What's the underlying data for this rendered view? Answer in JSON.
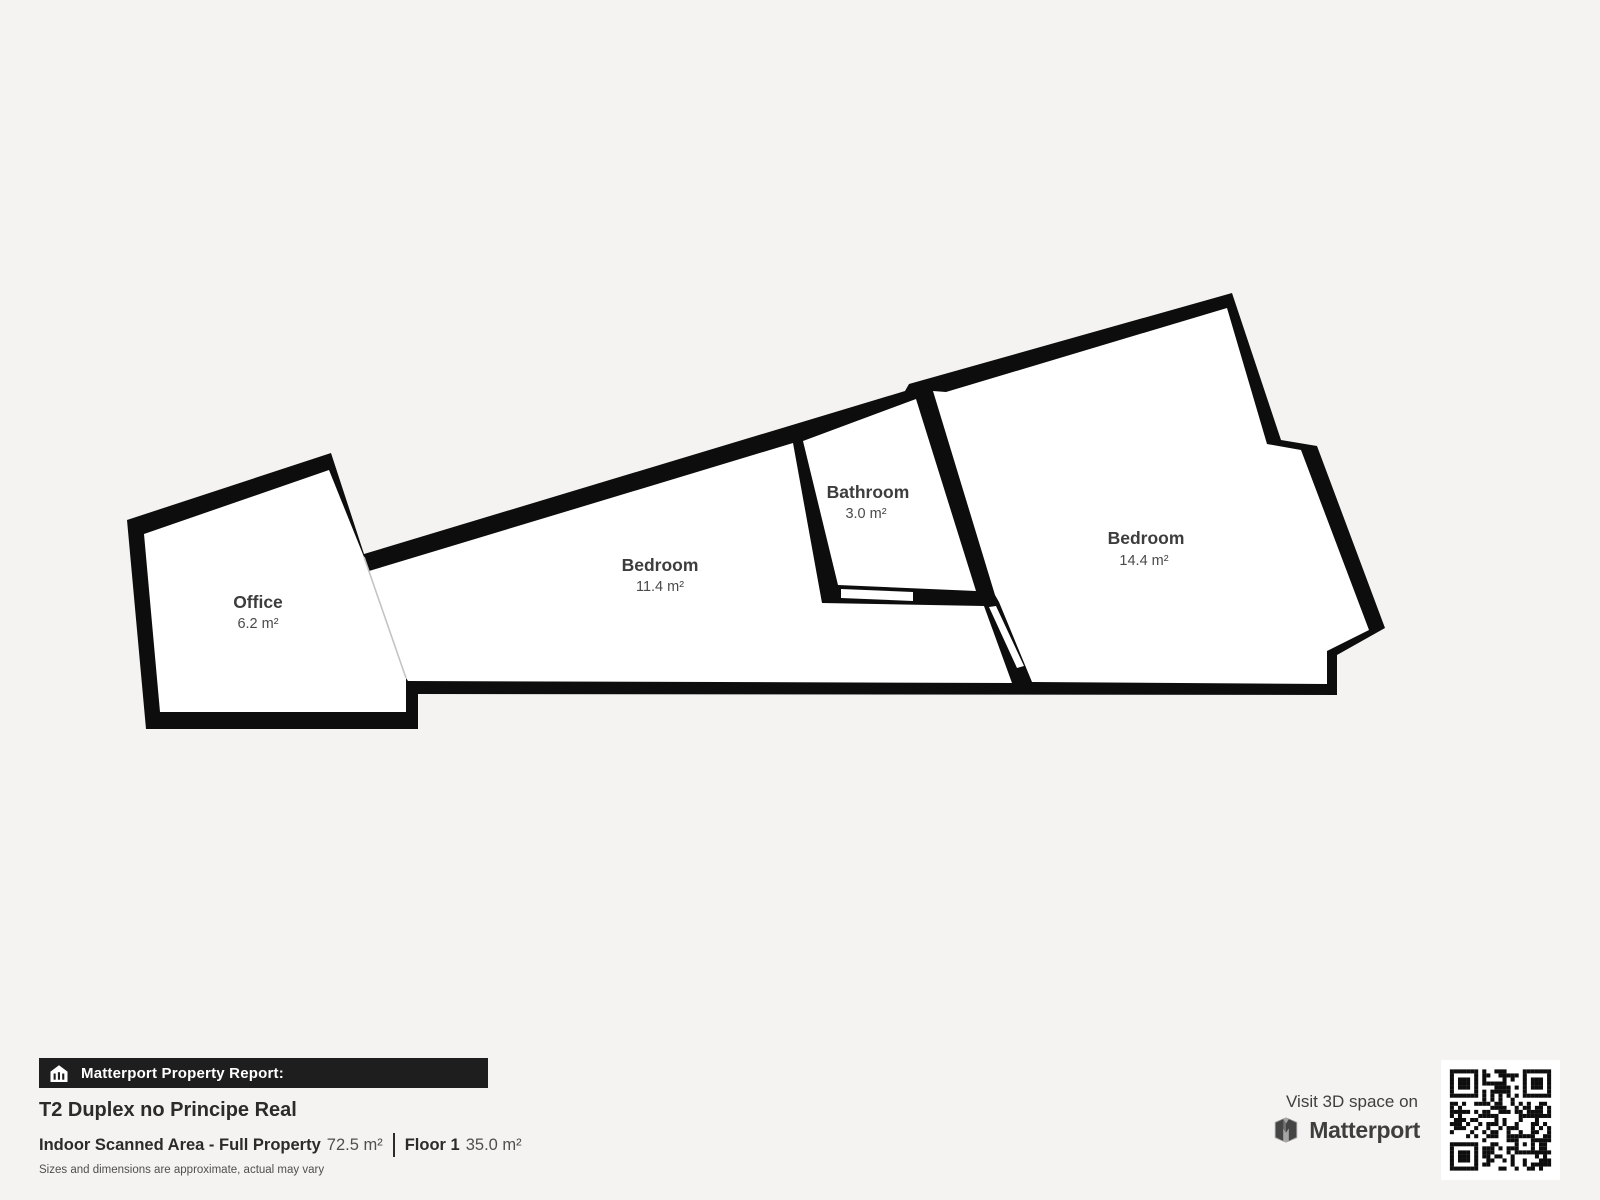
{
  "plan": {
    "rooms": [
      {
        "name": "Office",
        "area": "6.2 m²"
      },
      {
        "name": "Bedroom",
        "area": "11.4 m²"
      },
      {
        "name": "Bathroom",
        "area": "3.0 m²"
      },
      {
        "name": "Bedroom",
        "area": "14.4 m²"
      }
    ]
  },
  "report": {
    "badge": "Matterport Property Report:",
    "title": "T2 Duplex no Principe Real",
    "scanned_label": "Indoor Scanned Area - Full Property",
    "scanned_value": "72.5 m²",
    "floor_label": "Floor 1",
    "floor_value": "35.0 m²",
    "disclaimer": "Sizes and dimensions are approximate, actual may vary"
  },
  "promo": {
    "visit": "Visit 3D space on",
    "brand": "Matterport"
  },
  "icons": {
    "report_badge": "house-report-icon",
    "brand_mark": "matterport-logo-icon",
    "qr": "qr-code"
  },
  "colors": {
    "background": "#f4f3f1",
    "wall": "#0d0d0d",
    "room_fill": "#ffffff",
    "label": "#3d3d3d",
    "bar_background": "#1e1e1e",
    "open_boundary_line": "#c6c4c1"
  }
}
